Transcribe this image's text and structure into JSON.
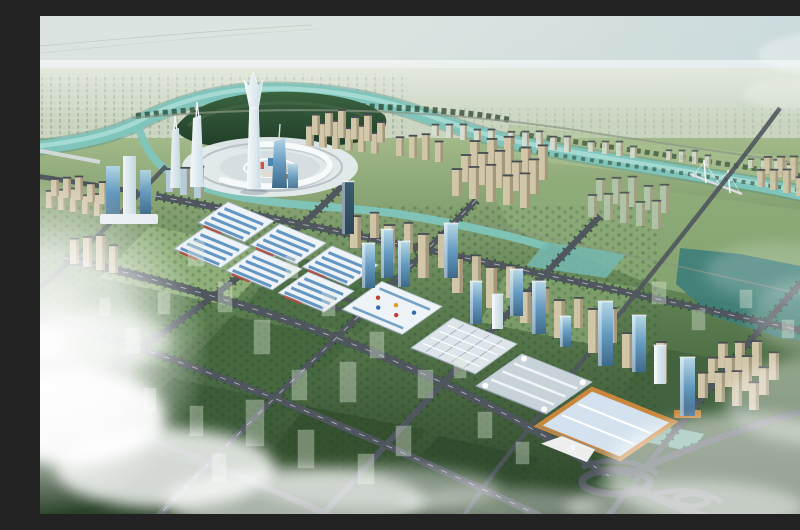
{
  "meta": {
    "label": "Aerial rendering of a planned riverside city: landmark split-crown spire over a circular plaza island, teal river oxbow, diagonal strip of blue-striped exhibition halls, glass office towers, beige residential rows, tree-lined road grid with green development blocks, and low clouds"
  },
  "palette": {
    "sky_top": "#dce4e1",
    "sky_mid": "#d8e2de",
    "sky_horizon": "#eef2e9",
    "sky_blue": "#b4cdd6",
    "cloud": "#ffffff",
    "distant_land": "#c9d3bd",
    "distant_city": "#a7b5a0",
    "distant_city_hi": "#c6cfba",
    "ground_top": "#a2b989",
    "ground_mid": "#5c7e50",
    "ground_deep": "#2a4228",
    "field_mid": "#8fae79",
    "field_light": "#adc296",
    "tree_dark": "#1f3b27",
    "tree_mid": "#3a6340",
    "tree_line": "#2c4d33",
    "river": "#80c5bc",
    "river_deep": "#4e938c",
    "river_light": "#bce8df",
    "lake": "#3f7f79",
    "pond": "#74b9b0",
    "road": "#4f565d",
    "road_dark": "#3d434a",
    "road_line": "#c6ccd0",
    "road_minor": "#8a9585",
    "hall_white": "#eef3f7",
    "hall_blue": "#5d92c2",
    "hall_red": "#c2402f",
    "hall_edge": "#b6c5d1",
    "grid_roof": "#dde4ea",
    "conv_grey": "#c8d2d9",
    "conv_ridge": "#f0f4f6",
    "orange": "#c8873c",
    "orange_roof": "#d3e2ee",
    "glass_hi": "#b3d6e4",
    "glass_mid": "#659ac0",
    "glass_lo": "#3e6a8a",
    "tower_dark": "#3b5d73",
    "tower_dark2": "#2c4757",
    "spire_hi": "#f6fafb",
    "spire_lo": "#cddee6",
    "white_tower": "#eef4f6",
    "white_tower_sh": "#c3d7df",
    "slab_blue": "#b6ccd8",
    "beige": "#d2c6a9",
    "beige_sh": "#9c8f74",
    "roof_dark": "#474d52",
    "pale_res": "#d8dfd1",
    "ghost": "#e0ebdb",
    "ghost_green": "#b5c9ae",
    "plaza": "#e6ecef",
    "plaza_ring": "#f7fafb",
    "plaza_inner": "#d5dfe2",
    "podium": "#e7edf1",
    "fountain": "#7fb8d4",
    "accent_blue": "#2e6fae",
    "accent_gold": "#d8a020"
  },
  "scene": {
    "tower_clusters": [
      {
        "name": "north-bank-homes-a",
        "x": 392,
        "y": 120,
        "cols": 5,
        "rows": 1,
        "dx": 14,
        "dy": 2,
        "w": 7,
        "h": 13,
        "color": "pale_res",
        "op": 0.95
      },
      {
        "name": "north-bank-homes-b",
        "x": 468,
        "y": 128,
        "cols": 5,
        "rows": 1,
        "dx": 14,
        "dy": 2,
        "w": 7,
        "h": 14,
        "color": "pale_res",
        "op": 0.9
      },
      {
        "name": "north-bank-homes-c",
        "x": 548,
        "y": 136,
        "cols": 4,
        "rows": 1,
        "dx": 14,
        "dy": 2,
        "w": 7,
        "h": 12,
        "color": "pale_res",
        "op": 0.85
      },
      {
        "name": "north-bank-homes-d",
        "x": 626,
        "y": 144,
        "cols": 4,
        "rows": 1,
        "dx": 13,
        "dy": 2,
        "w": 6,
        "h": 11,
        "color": "pale_res",
        "op": 0.8
      },
      {
        "name": "north-bank-homes-e",
        "x": 708,
        "y": 152,
        "cols": 4,
        "rows": 1,
        "dx": 13,
        "dy": 2,
        "w": 6,
        "h": 10,
        "color": "pale_res",
        "op": 0.75
      },
      {
        "name": "riverfront-row-west",
        "x": 266,
        "y": 130,
        "cols": 6,
        "rows": 2,
        "dx": 13,
        "dy": 1.5,
        "rdx": 6,
        "rdy": -11,
        "w": 8,
        "h": 24,
        "color": "beige"
      },
      {
        "name": "riverfront-row-west-2",
        "x": 356,
        "y": 140,
        "cols": 4,
        "rows": 1,
        "dx": 13,
        "dy": 2,
        "w": 8,
        "h": 22,
        "color": "beige"
      },
      {
        "name": "east-residential-cluster",
        "x": 430,
        "y": 152,
        "cols": 5,
        "rows": 3,
        "dx": 17,
        "dy": 3,
        "rdx": -9,
        "rdy": 14,
        "w": 10,
        "h": 32,
        "color": "beige"
      },
      {
        "name": "ghost-residential-rows",
        "x": 556,
        "y": 185,
        "cols": 5,
        "rows": 2,
        "dx": 16,
        "dy": 3,
        "rdx": -8,
        "rdy": 16,
        "w": 9,
        "h": 26,
        "color": "ghost_green",
        "op": 0.85
      },
      {
        "name": "far-east-cluster",
        "x": 724,
        "y": 158,
        "cols": 4,
        "rows": 2,
        "dx": 13,
        "dy": 3,
        "rdx": -7,
        "rdy": 13,
        "w": 8,
        "h": 20,
        "color": "beige",
        "op": 0.9
      },
      {
        "name": "west-edge-homes",
        "x": 6,
        "y": 192,
        "cols": 5,
        "rows": 2,
        "dx": 12,
        "dy": 2,
        "rdx": 5,
        "rdy": -12,
        "w": 8,
        "h": 20,
        "color": "beige"
      },
      {
        "name": "west-edge-towers",
        "x": 30,
        "y": 248,
        "cols": 4,
        "rows": 1,
        "dx": 13,
        "dy": 3,
        "w": 9,
        "h": 30,
        "color": "beige"
      },
      {
        "name": "strip-residential-row",
        "x": 310,
        "y": 232,
        "cols": 10,
        "rows": 1,
        "dx": 34,
        "dy": 15,
        "w": 11,
        "h": 38,
        "color": "beige"
      },
      {
        "name": "strip-residential-back-row",
        "x": 330,
        "y": 222,
        "cols": 8,
        "rows": 1,
        "dx": 34,
        "dy": 15,
        "w": 9,
        "h": 30,
        "color": "beige",
        "op": 0.95
      },
      {
        "name": "southeast-cluster",
        "x": 678,
        "y": 352,
        "cols": 4,
        "rows": 3,
        "dx": 17,
        "dy": 4,
        "rdx": -10,
        "rdy": 15,
        "w": 10,
        "h": 30,
        "color": "beige"
      },
      {
        "name": "west-mid-slabs",
        "x": 126,
        "y": 176,
        "cols": 3,
        "rows": 1,
        "dx": 14,
        "dy": 3,
        "w": 10,
        "h": 27,
        "color": "slab_blue"
      }
    ],
    "strip_towers": [
      [
        302,
        218,
        52,
        12,
        "dark"
      ],
      [
        322,
        272,
        44,
        13,
        "glass"
      ],
      [
        341,
        262,
        48,
        12,
        "glass"
      ],
      [
        358,
        271,
        45,
        12,
        "glass"
      ],
      [
        404,
        262,
        54,
        14,
        "glass"
      ],
      [
        430,
        308,
        42,
        12,
        "glass"
      ],
      [
        452,
        313,
        34,
        11,
        "white"
      ],
      [
        470,
        300,
        46,
        13,
        "glass"
      ],
      [
        492,
        318,
        52,
        14,
        "glass"
      ],
      [
        520,
        331,
        30,
        11,
        "glass"
      ],
      [
        558,
        350,
        64,
        15,
        "glass"
      ],
      [
        592,
        356,
        56,
        14,
        "glass"
      ],
      [
        614,
        368,
        38,
        12,
        "white"
      ],
      [
        640,
        400,
        58,
        15,
        "orange"
      ]
    ],
    "halls": {
      "u": [
        46,
        19
      ],
      "v": [
        -30,
        21
      ],
      "items": [
        {
          "cx": 196,
          "cy": 206,
          "kind": "striped"
        },
        {
          "cx": 248,
          "cy": 228,
          "kind": "striped"
        },
        {
          "cx": 300,
          "cy": 250,
          "kind": "striped"
        },
        {
          "cx": 172,
          "cy": 232,
          "kind": "striped"
        },
        {
          "cx": 224,
          "cy": 254,
          "kind": "striped"
        },
        {
          "cx": 276,
          "cy": 276,
          "kind": "striped"
        },
        {
          "cx": 352,
          "cy": 292,
          "kind": "mall",
          "u": [
            60,
            25
          ],
          "v": [
            -40,
            28
          ]
        },
        {
          "cx": 424,
          "cy": 330,
          "kind": "grid",
          "u": [
            64,
            26
          ],
          "v": [
            -42,
            30
          ]
        },
        {
          "cx": 494,
          "cy": 368,
          "kind": "curved",
          "u": [
            70,
            28
          ],
          "v": [
            -46,
            32
          ]
        },
        {
          "cx": 566,
          "cy": 408,
          "kind": "orange",
          "u": [
            82,
            33
          ],
          "v": [
            -54,
            37
          ]
        }
      ]
    },
    "ghost_buildings": [
      [
        148,
        250,
        16,
        26
      ],
      [
        178,
        296,
        14,
        30
      ],
      [
        214,
        338,
        16,
        34
      ],
      [
        252,
        384,
        15,
        30
      ],
      [
        118,
        298,
        12,
        22
      ],
      [
        86,
        338,
        14,
        26
      ],
      [
        60,
        300,
        10,
        18
      ],
      [
        246,
        262,
        12,
        22
      ],
      [
        282,
        300,
        13,
        24
      ],
      [
        330,
        342,
        14,
        26
      ],
      [
        378,
        382,
        15,
        28
      ],
      [
        300,
        386,
        16,
        40
      ],
      [
        206,
        430,
        18,
        46
      ],
      [
        258,
        452,
        16,
        38
      ],
      [
        318,
        468,
        16,
        30
      ],
      [
        150,
        420,
        13,
        30
      ],
      [
        104,
        396,
        12,
        24
      ],
      [
        438,
        422,
        14,
        26
      ],
      [
        476,
        448,
        13,
        22
      ],
      [
        414,
        362,
        12,
        22
      ],
      [
        612,
        288,
        14,
        22
      ],
      [
        652,
        314,
        13,
        20
      ],
      [
        700,
        292,
        12,
        18
      ],
      [
        742,
        322,
        12,
        18
      ],
      [
        172,
        466,
        14,
        28
      ],
      [
        356,
        440,
        15,
        30
      ]
    ]
  }
}
